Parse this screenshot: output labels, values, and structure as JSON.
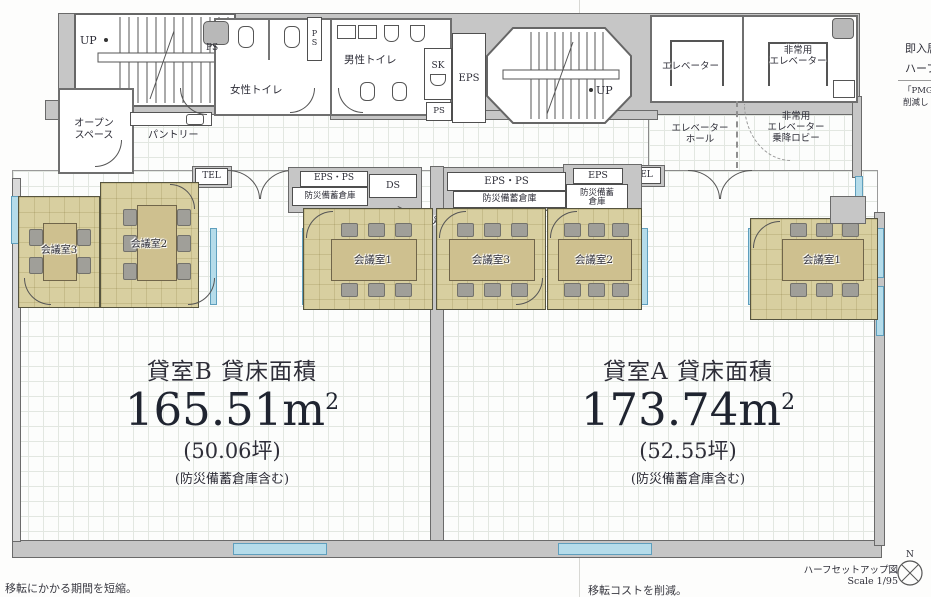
{
  "core": {
    "stair_up_left": "UP",
    "stair_up_right": "UP",
    "ps_top": "PS",
    "ps_shaft_p": "P",
    "ps_shaft_s": "S",
    "ps_small": "PS",
    "sk": "SK",
    "eps_shaft": "EPS",
    "women_toilet": "女性トイレ",
    "men_toilet": "男性トイレ",
    "open_space_1": "オープン",
    "open_space_2": "スペース",
    "pantry": "パントリー",
    "elevator": "エレベーター",
    "emergency_elevator_1": "非常用",
    "emergency_elevator_2": "エレベーター",
    "elevator_hall_1": "エレベーター",
    "elevator_hall_2": "ホール",
    "emergency_lobby_1": "非常用",
    "emergency_lobby_2": "エレベーター",
    "emergency_lobby_3": "乗降ロビー",
    "tel_left": "TEL",
    "tel_right": "TEL"
  },
  "service": {
    "eps_ps_left": "EPS・PS",
    "storage_left": "防災備蓄倉庫",
    "ds": "DS",
    "eps_ps_center": "EPS・PS",
    "storage_center": "防災備蓄倉庫",
    "eps_right": "EPS",
    "storage_right_1": "防災備蓄",
    "storage_right_2": "倉庫",
    "storage_callout": "防災備蓄倉庫"
  },
  "rooms": [
    {
      "label": "会議室3",
      "tenant": "B",
      "seats": 4
    },
    {
      "label": "会議室2",
      "tenant": "B",
      "seats": 6
    },
    {
      "label": "会議室1",
      "tenant": "B",
      "seats": 6
    },
    {
      "label": "会議室3",
      "tenant": "A",
      "seats": 6
    },
    {
      "label": "会議室2",
      "tenant": "A",
      "seats": 6
    },
    {
      "label": "会議室1",
      "tenant": "A",
      "seats": 6
    }
  ],
  "tenants": {
    "b": {
      "title": "貸室B 貸床面積",
      "area": "165.51m",
      "sup": "2",
      "tsubo": "(50.06坪)",
      "note": "(防災備蓄倉庫含む)"
    },
    "a": {
      "title": "貸室A 貸床面積",
      "area": "173.74m",
      "sup": "2",
      "tsubo": "(52.55坪)",
      "note": "(防災備蓄倉庫含む)"
    }
  },
  "annotations": {
    "bottom_left": "移転にかかる期間を短縮。",
    "bottom_right": "移転コストを削減。",
    "drawing_title": "ハーフセットアップ図",
    "scale": "Scale 1/95",
    "compass_n": "N",
    "side_text_1": "即入居",
    "side_text_2": "ハーフ",
    "side_text_3": "「PMG",
    "side_text_4": "削減し"
  },
  "colors": {
    "window": "#b5dcea",
    "meeting_room_fill": "#d8cfa0",
    "wall": "#c6c6c6"
  }
}
